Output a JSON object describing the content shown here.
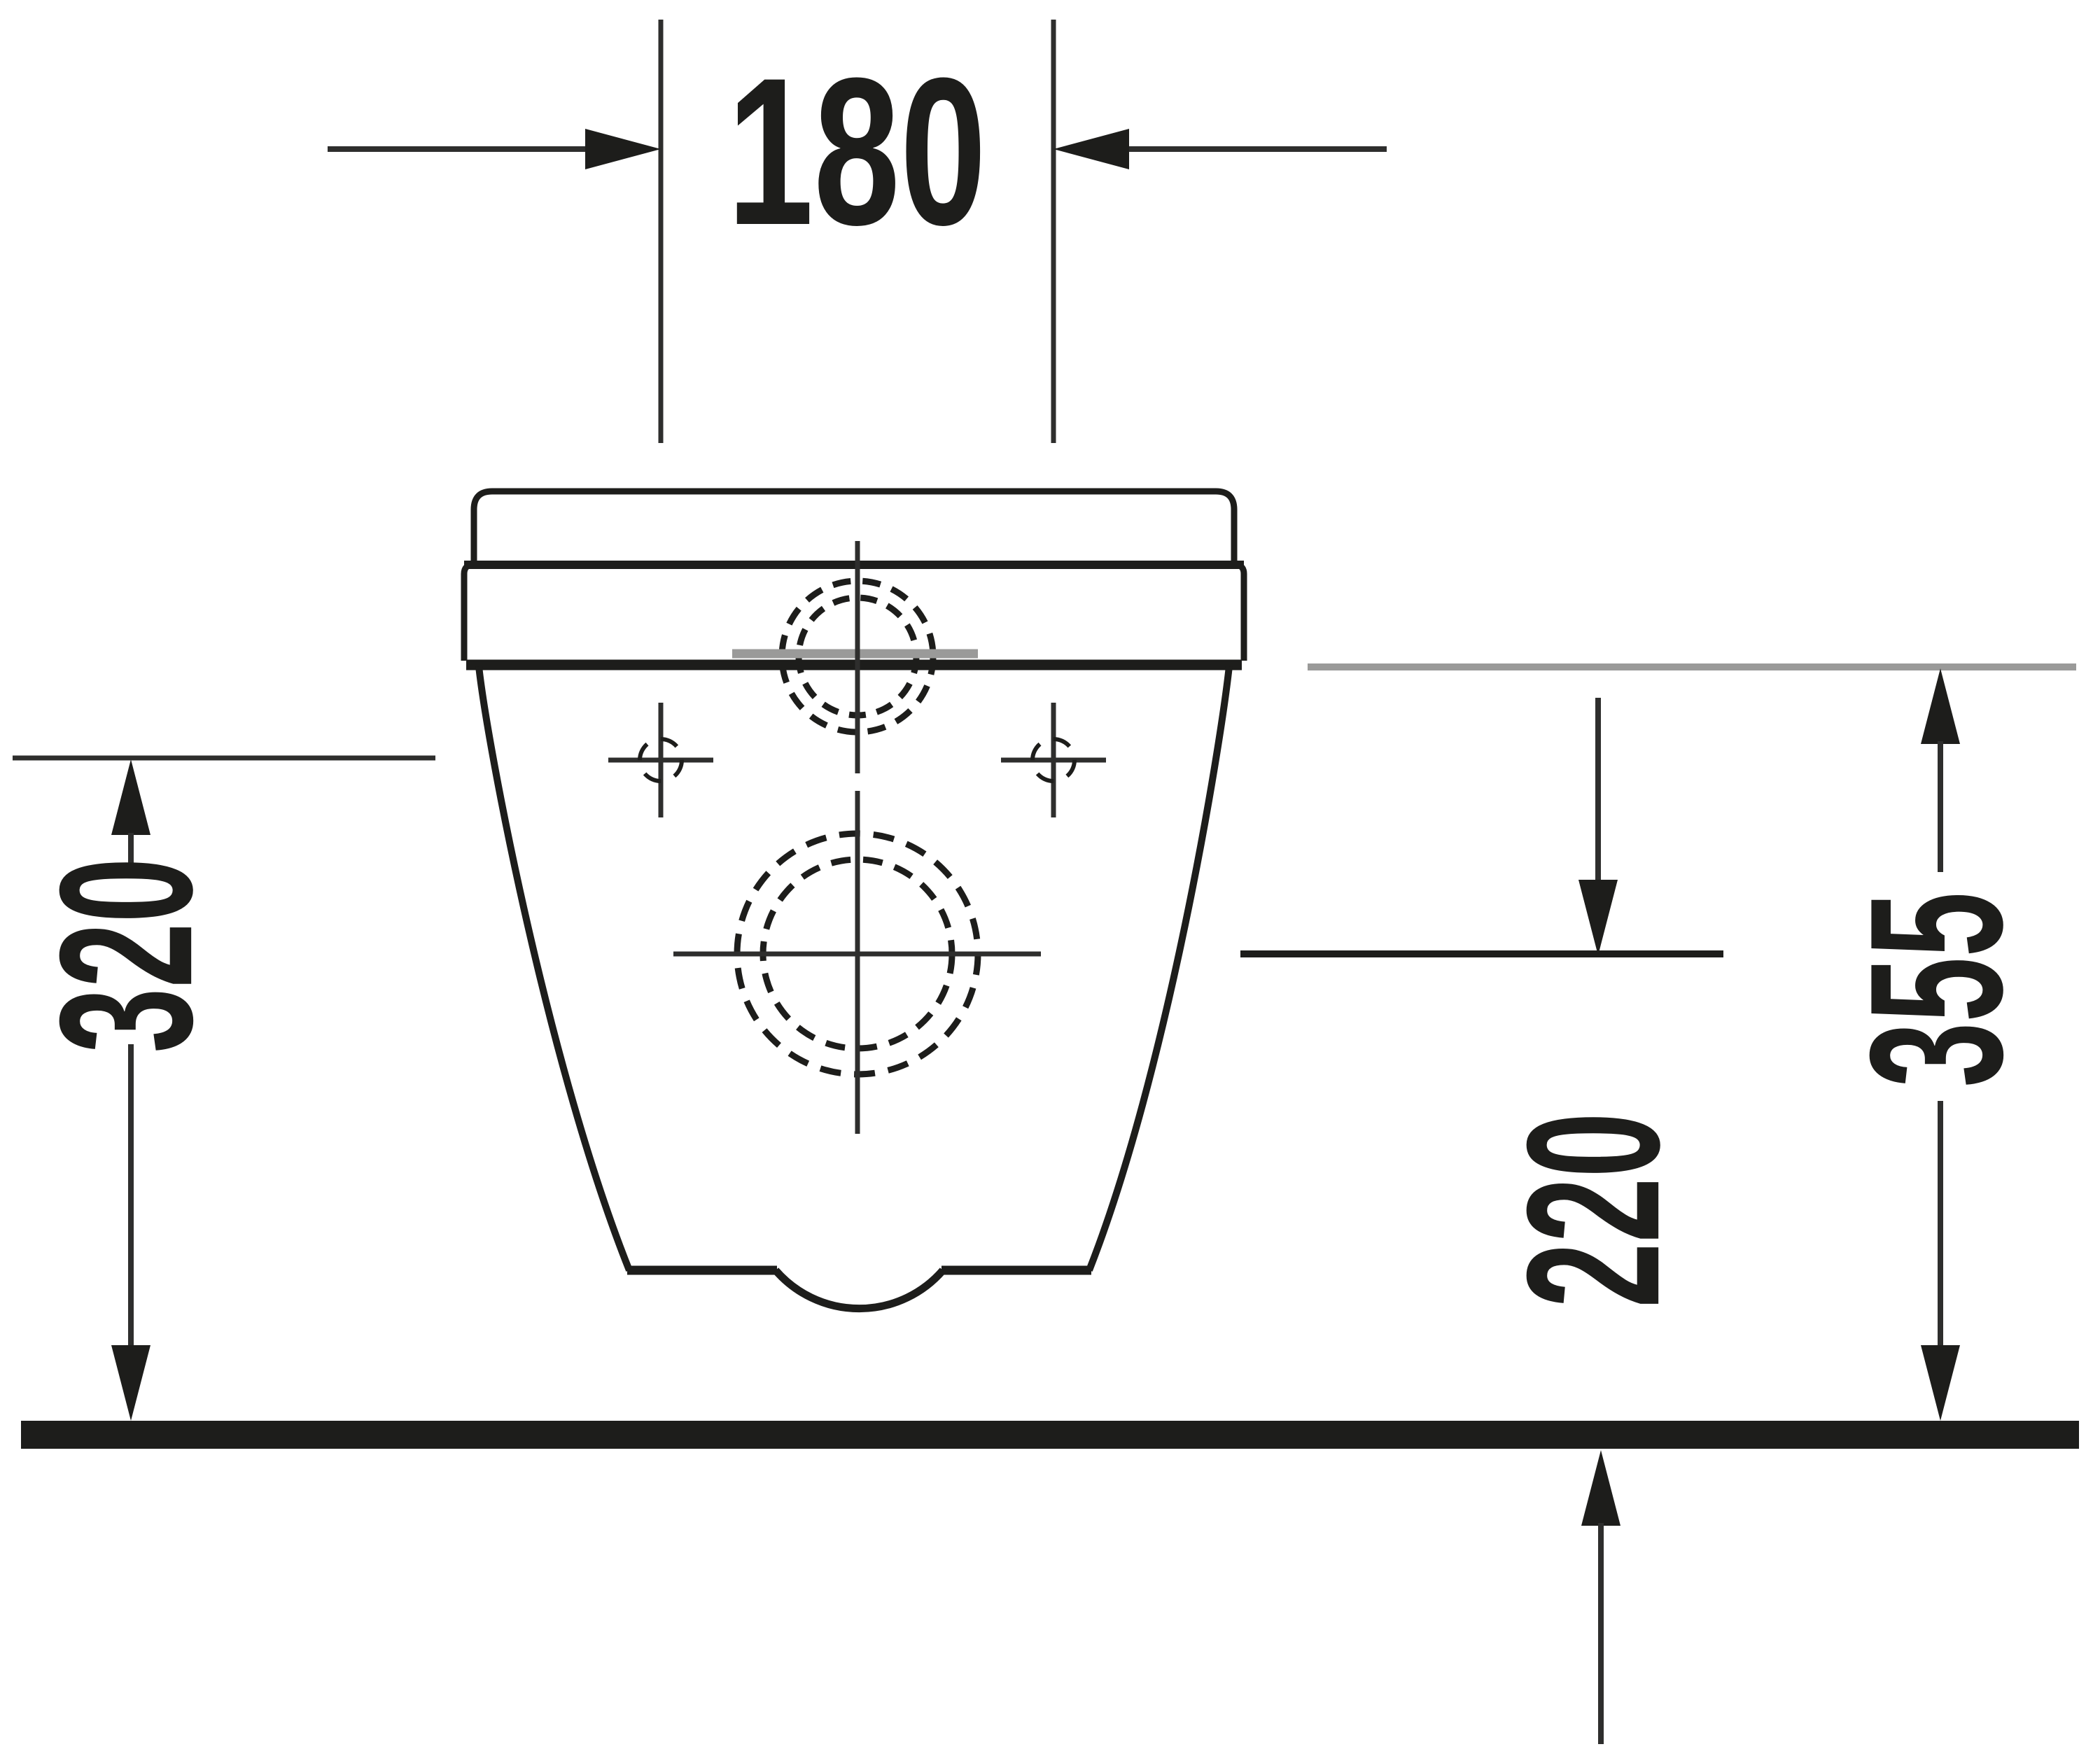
{
  "drawing": {
    "title": "Wall-hung toilet installation drawing (rear view)",
    "view": "rear elevation above floor line"
  },
  "dimensions": {
    "hole_spacing": "180",
    "left_height": "320",
    "outlet_height": "220",
    "rim_height": "355"
  },
  "colors": {
    "ink": "#1d1d1b",
    "line": "#2e2e2d",
    "gray": "#9a9a99",
    "background": "#ffffff"
  }
}
